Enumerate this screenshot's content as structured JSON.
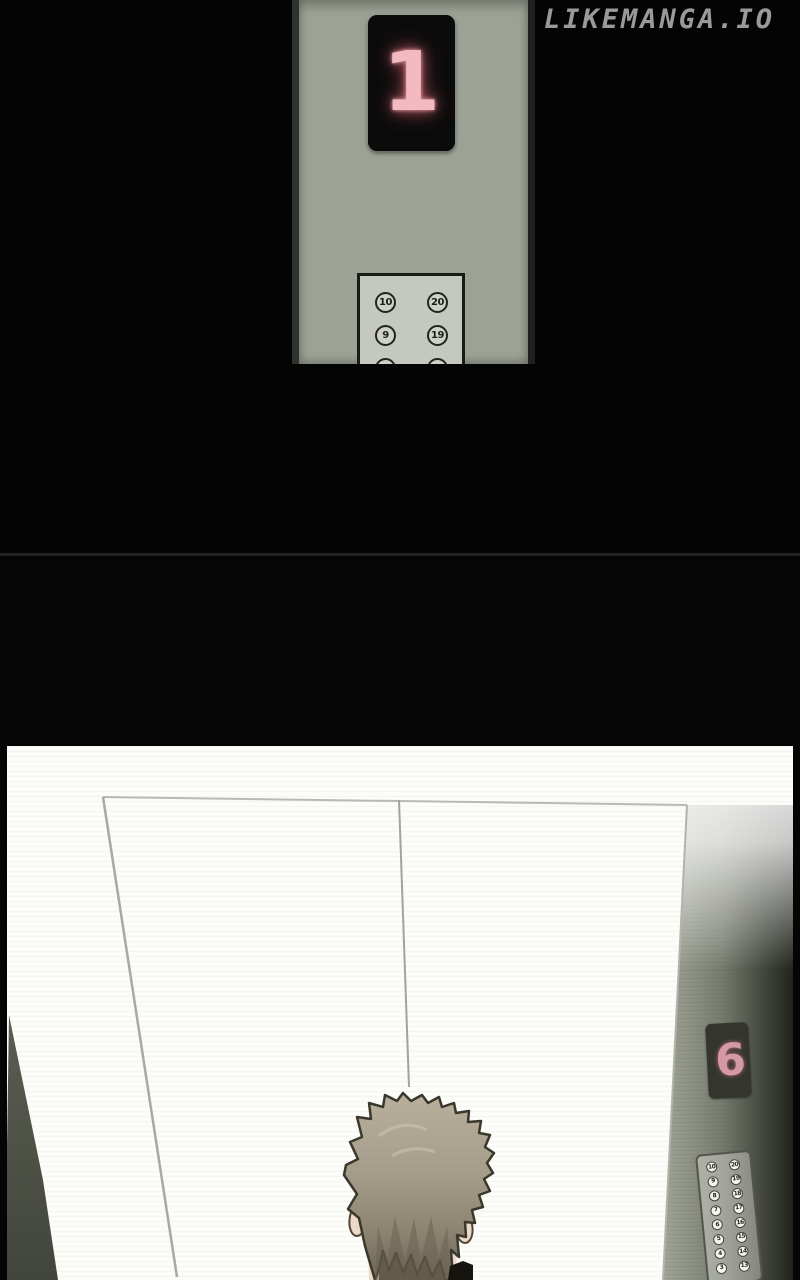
{
  "site": {
    "watermark": "LIKEMANGA.IO"
  },
  "hall_panel": {
    "floor_indicator": "1",
    "keypad_buttons": [
      "10",
      "20",
      "9",
      "19",
      "8",
      "18"
    ]
  },
  "car": {
    "floor_indicator": "6",
    "panel_left_column": [
      "10",
      "9",
      "8",
      "7",
      "6",
      "5",
      "4",
      "3"
    ],
    "panel_right_column": [
      "20",
      "19",
      "18",
      "17",
      "16",
      "15",
      "14",
      "13"
    ]
  },
  "colors": {
    "indicator_digit_large": "#f4bac1",
    "indicator_digit_small": "#d39aa5",
    "brushed_metal": "#9ca295",
    "watermark_text": "#9a9a9a",
    "background": "#000000",
    "divider": "#242424"
  }
}
